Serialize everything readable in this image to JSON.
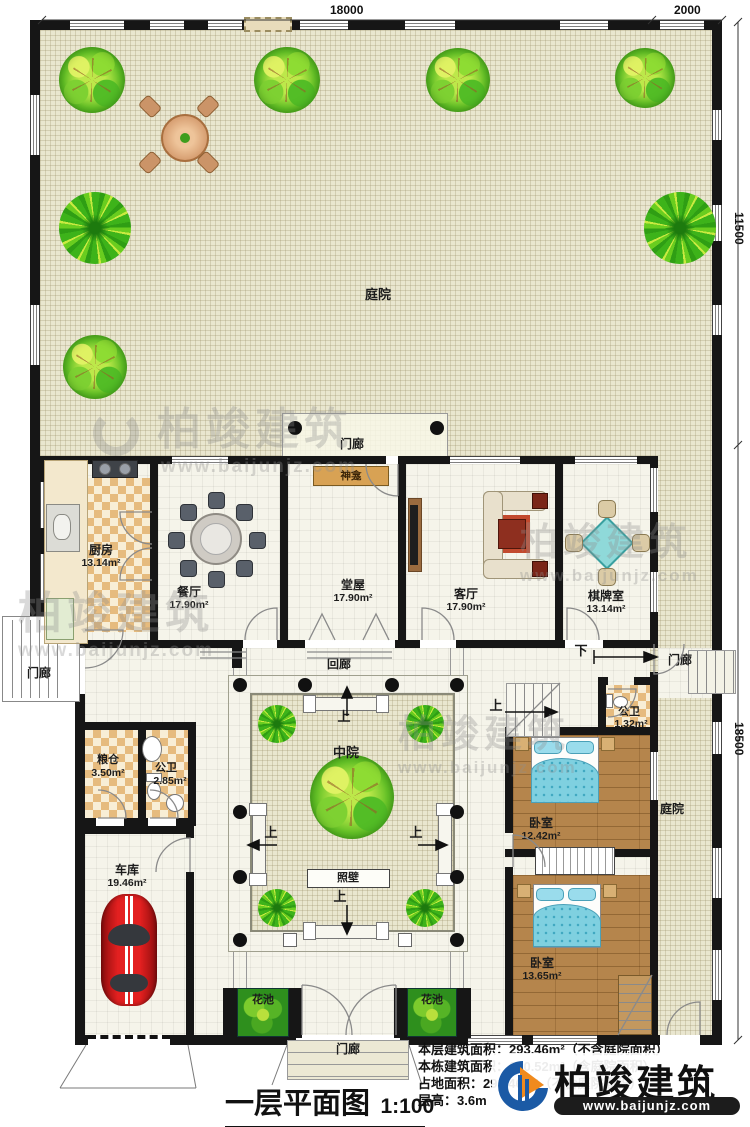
{
  "dims": {
    "top_main": "18000",
    "top_right": "2000",
    "right_upper": "11500",
    "right_lower": "18500"
  },
  "labels": {
    "courtyard_top": "庭院",
    "courtyard_right": "庭院",
    "porch": "门廊",
    "corridor": "回廊",
    "midcourt": "中院",
    "screen_wall": "照壁",
    "shrine": "神龛",
    "flower": "花池",
    "up": "上",
    "down": "下"
  },
  "rooms": {
    "kitchen": {
      "name": "厨房",
      "area": "13.14m²"
    },
    "dining": {
      "name": "餐厅",
      "area": "17.90m²"
    },
    "hall": {
      "name": "堂屋",
      "area": "17.90m²"
    },
    "living": {
      "name": "客厅",
      "area": "17.90m²"
    },
    "chess": {
      "name": "棋牌室",
      "area": "13.14m²"
    },
    "granary": {
      "name": "粮仓",
      "area": "3.50m²"
    },
    "bath_left": {
      "name": "公卫",
      "area": "2.85m²"
    },
    "bath_right": {
      "name": "公卫",
      "area": "1.32m²"
    },
    "garage": {
      "name": "车库",
      "area": "19.46m²"
    },
    "bedroom1": {
      "name": "卧室",
      "area": "12.42m²"
    },
    "bedroom2": {
      "name": "卧室",
      "area": "13.65m²"
    }
  },
  "footer": {
    "title": "一层平面图",
    "scale": "1:100",
    "line1": "本层建筑面积：293.46m²（不含庭院面积）",
    "line2": "本栋建筑面积：640.52m²（含庭院面积）",
    "line3": "占地面积：293.46m²（不含庭院面积）",
    "line4": "层高：3.6m"
  },
  "brand": {
    "name": "柏竣建筑",
    "url": "www.baijunjz.com"
  }
}
